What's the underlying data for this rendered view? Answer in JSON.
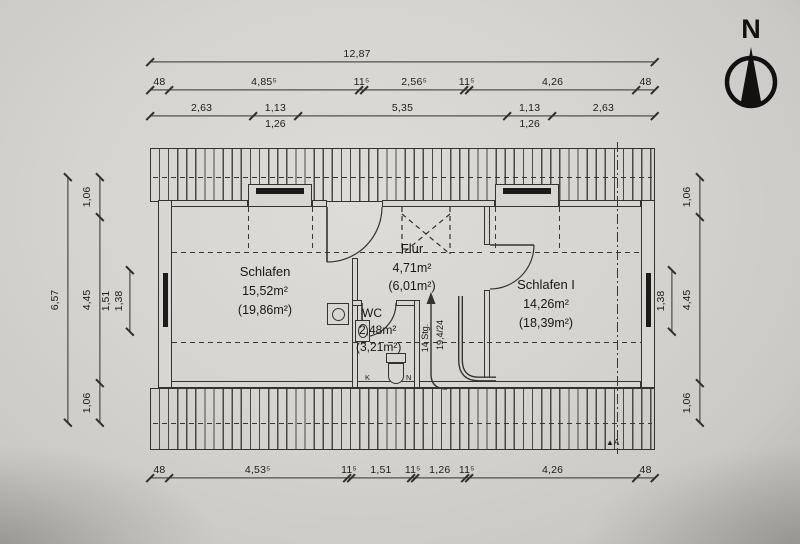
{
  "compass": {
    "label": "N"
  },
  "dimensions": {
    "top_total": "12,87",
    "top_row2": {
      "labels": [
        "48",
        "4,85⁵",
        "11⁵",
        "2,56⁵",
        "11⁵",
        "4,26",
        "48"
      ]
    },
    "top_row3": {
      "labels": [
        "2,63",
        "1,13",
        "5,35",
        "1,13",
        "2,63"
      ],
      "sub_labels": [
        "1,26",
        "1,26"
      ]
    },
    "bottom_row": {
      "labels": [
        "48",
        "4,53⁵",
        "11⁵",
        "1,51",
        "11⁵",
        "1,26",
        "11⁵",
        "4,26",
        "48"
      ]
    },
    "left": {
      "total": "6,57",
      "chain": [
        "1,06",
        "4,45",
        "1,06"
      ],
      "window": [
        "1,51",
        "1,38"
      ]
    },
    "right": {
      "chain": [
        "1,06",
        "4,45",
        "1,06"
      ],
      "window": [
        "1,51",
        "1,38"
      ]
    }
  },
  "rooms": {
    "schlafen": {
      "name": "Schlafen",
      "area": "15,52m²",
      "area_gross": "(19,86m²)"
    },
    "flur": {
      "name": "Flur",
      "area": "4,71m²",
      "area_gross": "(6,01m²)"
    },
    "wc": {
      "name": "WC",
      "area": "2,48m²",
      "area_gross": "(3,21m²)"
    },
    "schlafen1": {
      "name": "Schlafen I",
      "area": "14,26m²",
      "area_gross": "(18,39m²)"
    }
  },
  "stairs": {
    "steps": "14 Stg.",
    "ratio": "19,4/24"
  },
  "section": {
    "label": "A"
  },
  "wc_marks": {
    "left": "K",
    "right": "N"
  },
  "colors": {
    "paper": "#d6d4d0",
    "line": "#36332e"
  }
}
